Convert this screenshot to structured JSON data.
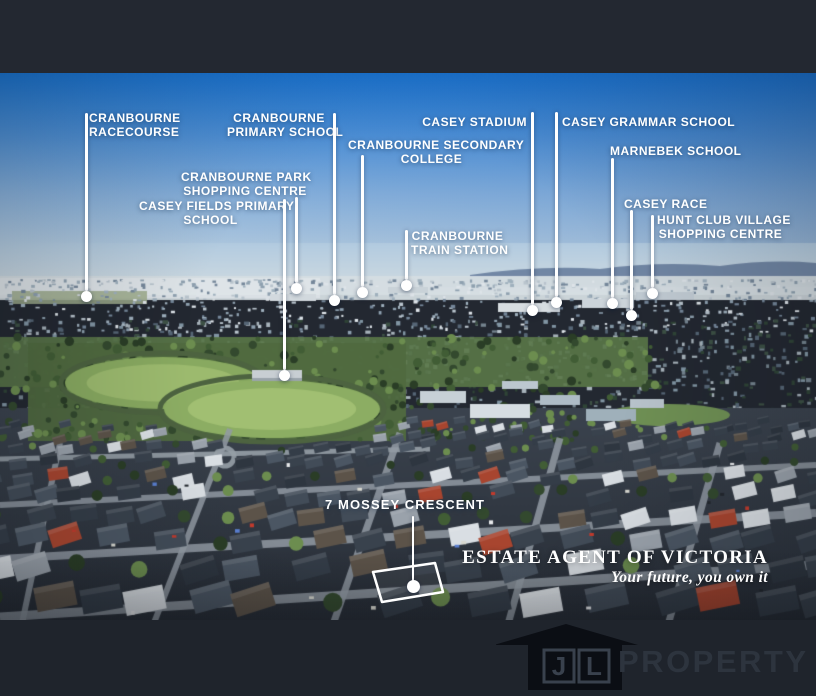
{
  "callouts": [
    {
      "name": "cranbourne-racecourse",
      "lines": [
        "CRANBOURNE",
        "RACECOURSE"
      ]
    },
    {
      "name": "cranbourne-primary-school",
      "lines": [
        "CRANBOURNE",
        "PRIMARY SCHOOL"
      ]
    },
    {
      "name": "cranbourne-park-shopping-centre",
      "lines": [
        "CRANBOURNE PARK",
        "SHOPPING CENTRE"
      ]
    },
    {
      "name": "casey-fields-primary-school",
      "lines": [
        "CASEY FIELDS PRIMARY",
        "SCHOOL"
      ]
    },
    {
      "name": "cranbourne-secondary-college",
      "lines": [
        "CRANBOURNE SECONDARY",
        "COLLEGE"
      ]
    },
    {
      "name": "casey-stadium",
      "lines": [
        "CASEY STADIUM",
        ""
      ]
    },
    {
      "name": "cranbourne-train-station",
      "lines": [
        "CRANBOURNE",
        "TRAIN STATION"
      ]
    },
    {
      "name": "casey-grammar-school",
      "lines": [
        "CASEY GRAMMAR SCHOOL",
        ""
      ]
    },
    {
      "name": "marnebek-school",
      "lines": [
        "MARNEBEK SCHOOL",
        ""
      ]
    },
    {
      "name": "casey-race",
      "lines": [
        "CASEY RACE",
        ""
      ]
    },
    {
      "name": "hunt-club-village-shopping-centre",
      "lines": [
        "HUNT CLUB VILLAGE",
        "SHOPPING CENTRE"
      ]
    }
  ],
  "property": {
    "label": "7 MOSSEY CRESCENT"
  },
  "branding": {
    "agency": "ESTATE AGENT OF VICTORIA",
    "tagline": "Your future, you own it",
    "monogram_left": "J",
    "monogram_right": "L",
    "wordmark": "PROPERTY"
  },
  "colors": {
    "label_text": "#ffffff",
    "leader_line": "#ffffff",
    "letterbox_top": "#232831",
    "letterbox_bottom": "#1f242c",
    "sky_top": "#1a75d3",
    "oval_green": "#8cad63",
    "red_roof": "#a8452f"
  }
}
